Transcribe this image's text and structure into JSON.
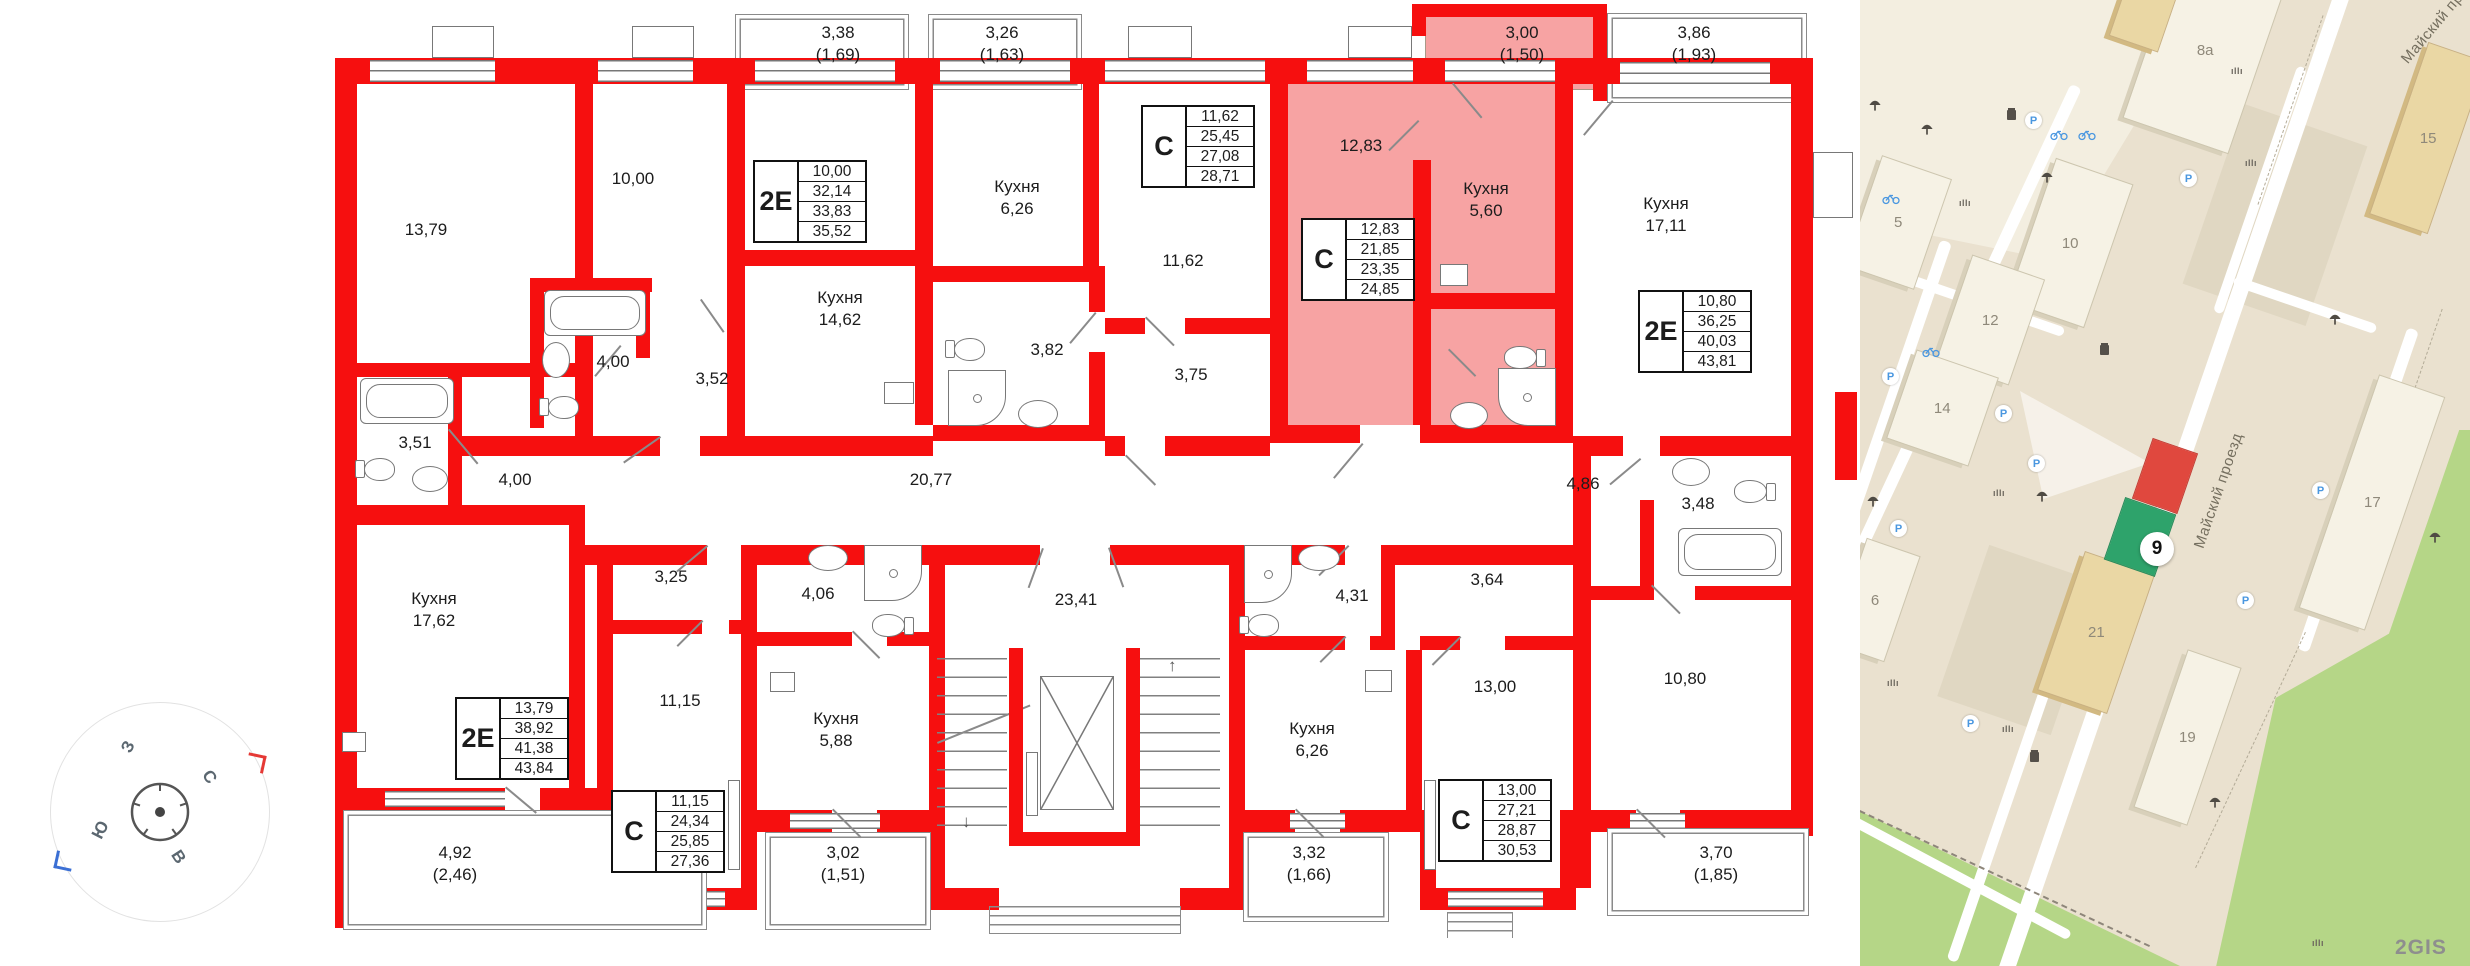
{
  "plan": {
    "labels": [
      {
        "l1": "13,79"
      },
      {
        "l1": "10,00"
      },
      {
        "l1": "3,38",
        "l2": "(1,69)"
      },
      {
        "l1": "3,26",
        "l2": "(1,63)"
      },
      {
        "l1": "Кухня",
        "l2": "6,26"
      },
      {
        "l1": "Кухня",
        "l2": "14,62"
      },
      {
        "l1": "3,00",
        "l2": "(1,50)"
      },
      {
        "l1": "12,83"
      },
      {
        "l1": "Кухня",
        "l2": "5,60"
      },
      {
        "l1": "3,86",
        "l2": "(1,93)"
      },
      {
        "l1": "Кухня",
        "l2": "17,11"
      },
      {
        "l1": "11,62"
      },
      {
        "l1": "3,82"
      },
      {
        "l1": "3,75"
      },
      {
        "l1": "3,51"
      },
      {
        "l1": "4,00"
      },
      {
        "l1": "3,52"
      },
      {
        "l1": "4,00"
      },
      {
        "l1": "20,77"
      },
      {
        "l1": "4,86"
      },
      {
        "l1": "3,48"
      },
      {
        "l1": "3,64"
      },
      {
        "l1": "Кухня",
        "l2": "17,62"
      },
      {
        "l1": "3,25"
      },
      {
        "l1": "11,15"
      },
      {
        "l1": "4,06"
      },
      {
        "l1": "Кухня",
        "l2": "5,88"
      },
      {
        "l1": "23,41"
      },
      {
        "l1": "4,31"
      },
      {
        "l1": "Кухня",
        "l2": "6,26"
      },
      {
        "l1": "13,00"
      },
      {
        "l1": "10,80"
      },
      {
        "l1": "4,92",
        "l2": "(2,46)"
      },
      {
        "l1": "3,02",
        "l2": "(1,51)"
      },
      {
        "l1": "3,32",
        "l2": "(1,66)"
      },
      {
        "l1": "3,70",
        "l2": "(1,85)"
      }
    ],
    "tables": [
      {
        "type": "2Е",
        "v": [
          "10,00",
          "32,14",
          "33,83",
          "35,52"
        ]
      },
      {
        "type": "С",
        "v": [
          "11,62",
          "25,45",
          "27,08",
          "28,71"
        ]
      },
      {
        "type": "С",
        "v": [
          "12,83",
          "21,85",
          "23,35",
          "24,85"
        ]
      },
      {
        "type": "2Е",
        "v": [
          "10,80",
          "36,25",
          "40,03",
          "43,81"
        ]
      },
      {
        "type": "2Е",
        "v": [
          "13,79",
          "38,92",
          "41,38",
          "43,84"
        ]
      },
      {
        "type": "С",
        "v": [
          "11,15",
          "24,34",
          "25,85",
          "27,36"
        ]
      },
      {
        "type": "С",
        "v": [
          "13,00",
          "27,21",
          "28,87",
          "30,53"
        ]
      }
    ]
  },
  "compass": {
    "north": "С",
    "south": "Ю",
    "west": "З",
    "east": "В"
  },
  "map": {
    "street_label": "Майский проезд",
    "street_label_short": "Майский пр.",
    "badge": "9",
    "watermark": "2GIS",
    "building_labels": [
      "5",
      "8а",
      "10",
      "12",
      "14",
      "15",
      "17",
      "19",
      "21",
      "6"
    ]
  }
}
